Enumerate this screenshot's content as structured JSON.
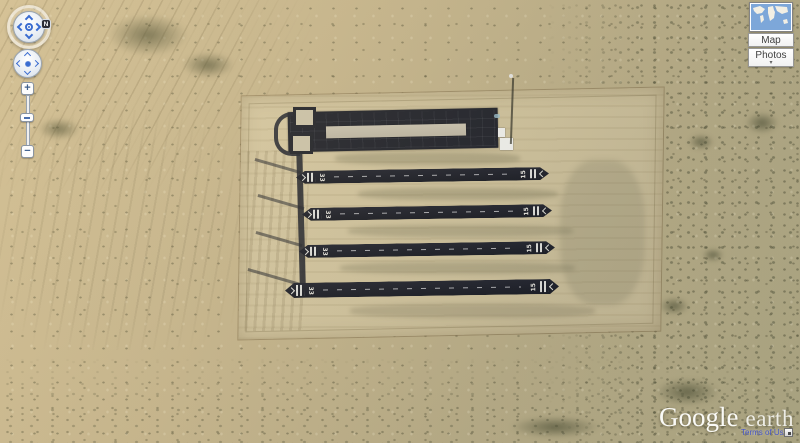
{
  "app": {
    "name": "Google Earth"
  },
  "controls": {
    "look_joystick": {
      "north_indicator": "N"
    },
    "zoom_slider": {
      "zoom_in": "+",
      "zoom_out": "−"
    }
  },
  "layer_switcher": {
    "map_button": "Map",
    "photos_button": "Photos",
    "photos_dropdown_arrow": "▾",
    "overview_map": "world-map-thumbnail"
  },
  "branding": {
    "logo_google": "Google",
    "logo_earth": "earth",
    "terms_of_use": "Terms of Use"
  },
  "scene": {
    "subject": "Oblique satellite view of a desert scale-model airfield: graded rectangular pad with a dark apron, model strip and four parallel marked runways",
    "colors": {
      "desert_sand": "#c6b58c",
      "graded_area": "#d4c7a0",
      "asphalt": "#22242b",
      "runway_strip": "#c9c2ae",
      "markings": "#e9e9e2",
      "vegetation": "#4f523a"
    },
    "airfield": {
      "runways": [
        {
          "left_designator": "33",
          "right_designator": "15"
        },
        {
          "left_designator": "33",
          "right_designator": "15"
        },
        {
          "left_designator": "33",
          "right_designator": "15"
        },
        {
          "left_designator": "33",
          "right_designator": "15"
        }
      ]
    }
  }
}
